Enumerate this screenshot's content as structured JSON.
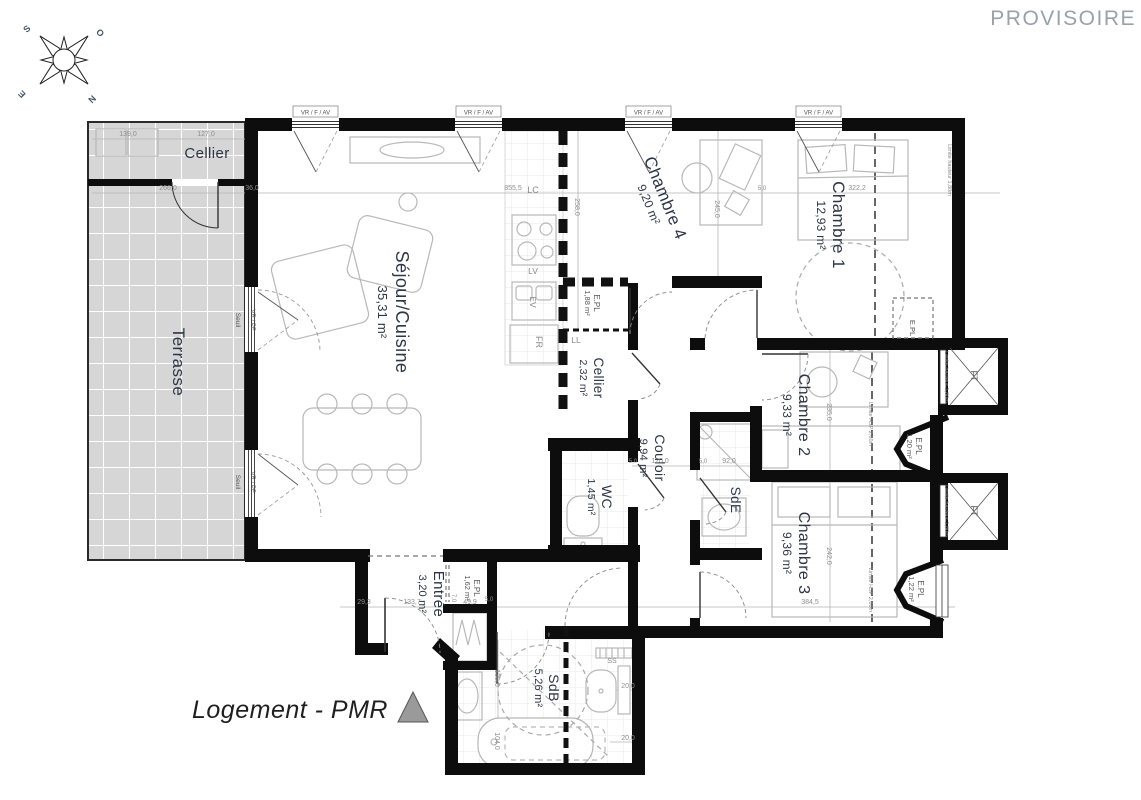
{
  "watermark": "PROVISOIRE",
  "title": "Logement - PMR",
  "compass": {
    "s": "S",
    "o": "O",
    "e": "E",
    "n": "N"
  },
  "rooms": {
    "terrasse": {
      "name": "Terrasse"
    },
    "cellier_ext": {
      "name": "Cellier"
    },
    "sejour": {
      "name": "Séjour/Cuisine",
      "area": "35,31 m²"
    },
    "chambre4": {
      "name": "Chambre 4",
      "area": "9,20 m²"
    },
    "chambre1": {
      "name": "Chambre 1",
      "area": "12,93 m²"
    },
    "cellier": {
      "name": "Cellier",
      "area": "2,32 m²"
    },
    "couloir": {
      "name": "Couloir",
      "area": "9,94 m²"
    },
    "wc": {
      "name": "WC",
      "area": "1,45 m²"
    },
    "sde": {
      "name": "SdE"
    },
    "chambre2": {
      "name": "Chambre 2",
      "area": "9,33 m²"
    },
    "chambre3": {
      "name": "Chambre 3",
      "area": "9,36 m²"
    },
    "entree": {
      "name": "Entrée",
      "area": "3,20 m²"
    },
    "sdb": {
      "name": "SdB",
      "area": "5,26 m²"
    }
  },
  "closets": {
    "epl1": {
      "name": "E.PL",
      "area": "1,88 m²"
    },
    "epl2": {
      "name": "E.PL",
      "area": "1,62 m²"
    },
    "epl3": {
      "name": "E.PL",
      "area": "1,20 m²"
    },
    "epl4": {
      "name": "E.PL",
      "area": "1,22 m²"
    },
    "epl5": {
      "name": "E.PL"
    }
  },
  "appliances": {
    "lc": "LC",
    "lv": "LV",
    "ev": "EV",
    "fr": "FR",
    "ll": "LL",
    "ss": "SS",
    "ft": "FT"
  },
  "wall_labels": {
    "window": "VR / F / AV",
    "terrace_window": "VR / PF",
    "seuil": "Seuil",
    "limite_hauteur": "Limite hauteur 1,80m",
    "limite_hsp": "Limite HSP 2,60m"
  },
  "dims": {
    "a": "139,0",
    "b": "127,0",
    "c": "266,0",
    "d": "36,0",
    "e": "855,5",
    "f": "322,2",
    "g": "258,0",
    "h": "245,0",
    "i": "235,0",
    "j": "242,0",
    "k": "384,5",
    "l": "120,0",
    "m": "92,0",
    "n": "133,7",
    "o": "49,9",
    "p": "29,3",
    "q": "138,0",
    "r": "104,0",
    "s": "20,0",
    "t": "5,0",
    "u": "7,0"
  }
}
